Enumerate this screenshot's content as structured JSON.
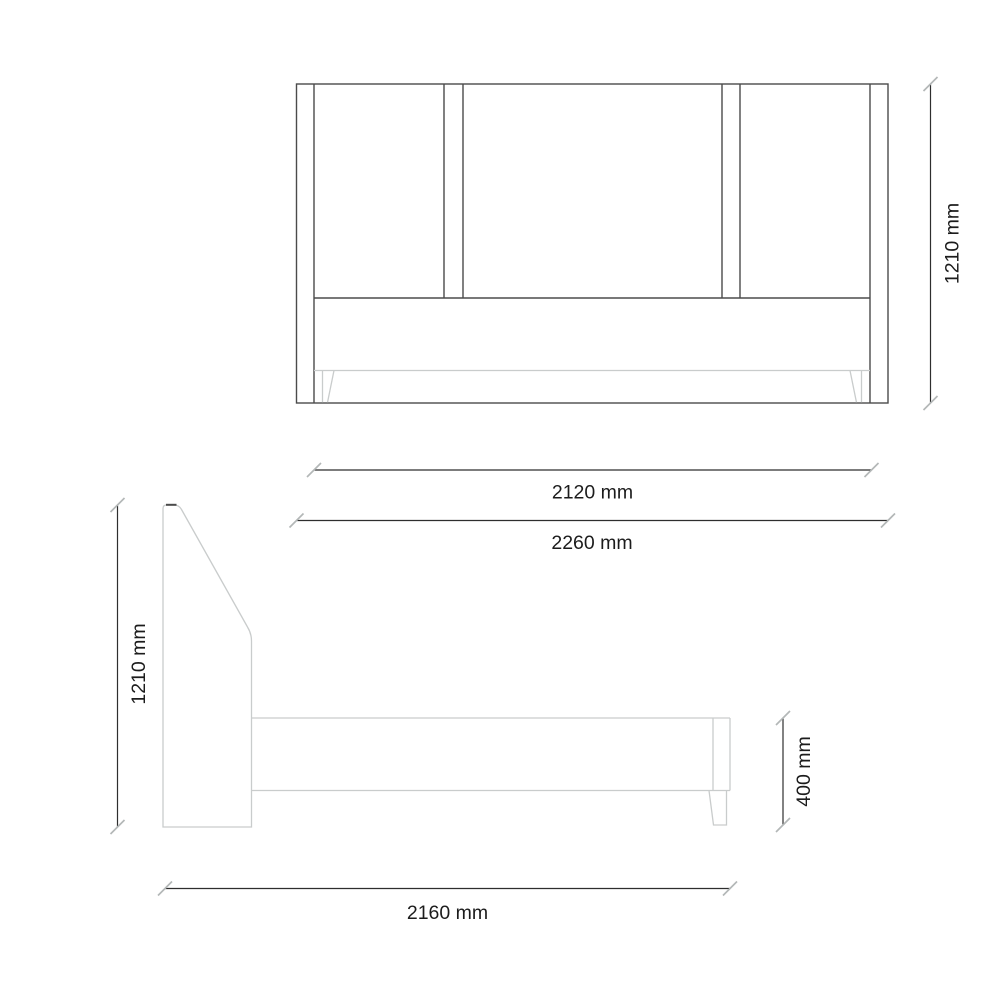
{
  "colors": {
    "background": "#ffffff",
    "outline_dark": "#4b4b4b",
    "outline_light": "#c9cccc",
    "dimension_line": "#2e2e2e",
    "tick": "#b3b7b7",
    "label": "#1c1c1c"
  },
  "dimensions": {
    "front_height": "1210 mm",
    "front_inner_width": "2120 mm",
    "front_outer_width": "2260 mm",
    "side_height": "1210 mm",
    "side_base_height": "400 mm",
    "side_length": "2160 mm"
  }
}
